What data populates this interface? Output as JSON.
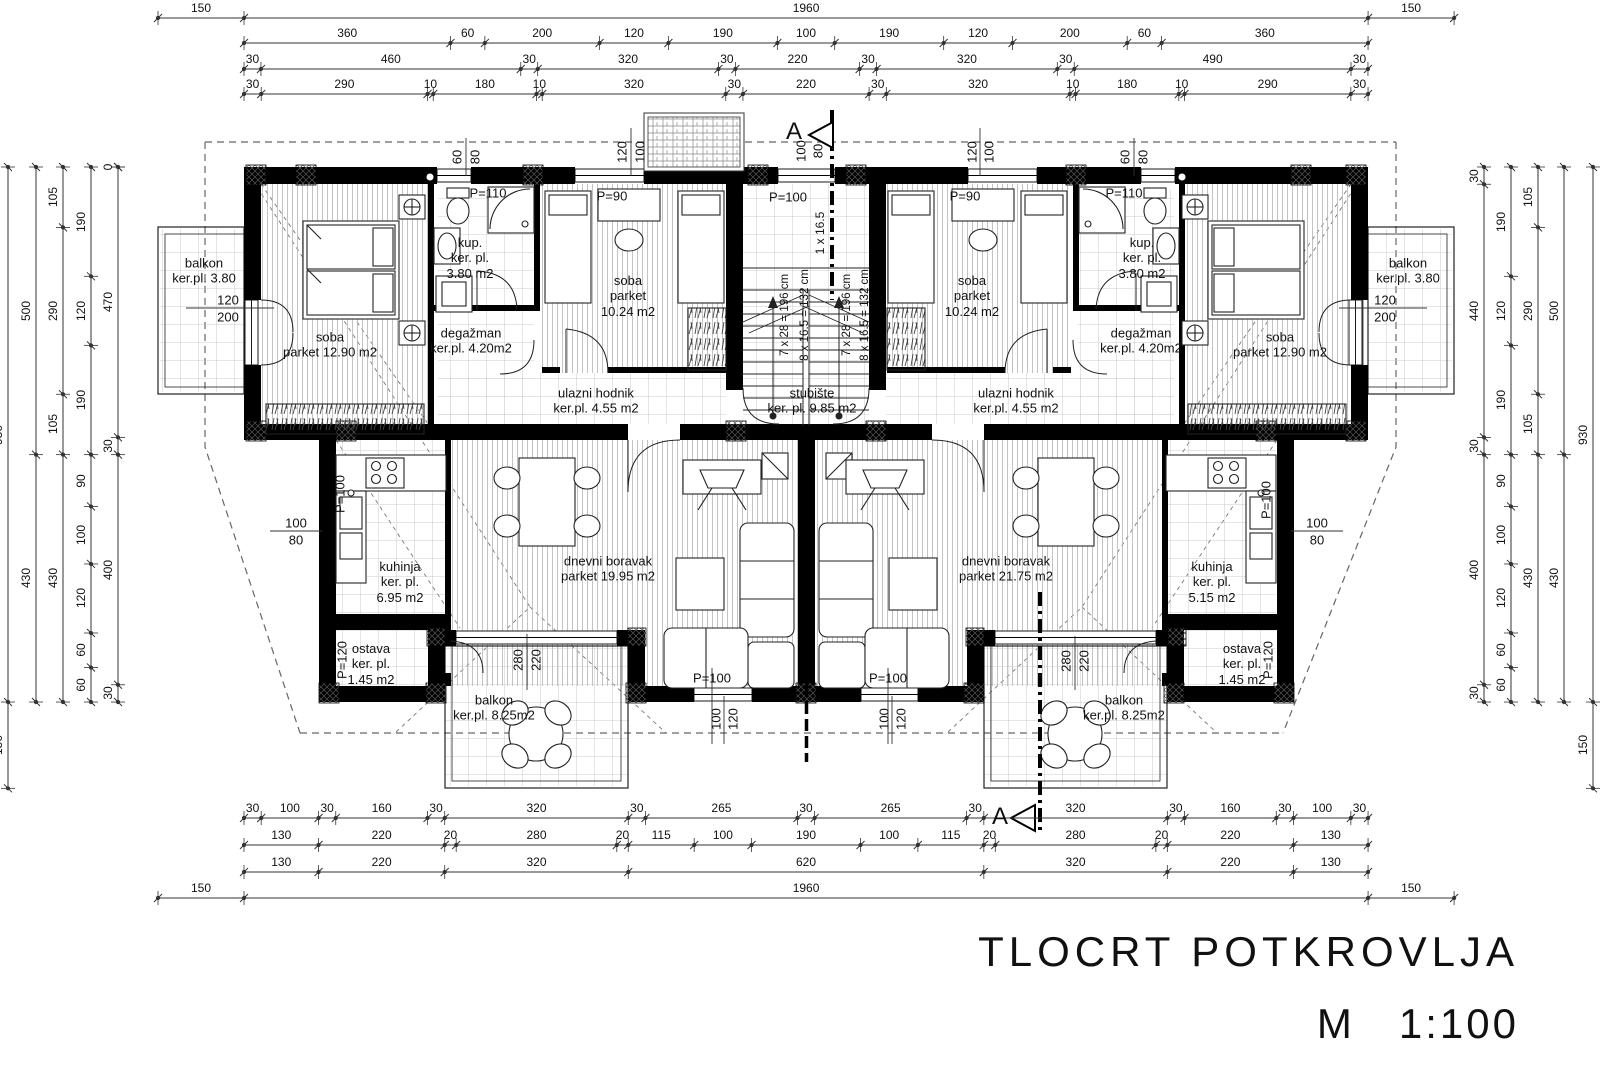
{
  "drawing": {
    "title": "TLOCRT  POTKROVLJA",
    "scale_label": "M   1:100"
  },
  "dim_chains": [
    {
      "axis": "h",
      "line": 18,
      "start": 158,
      "k": 0.5735,
      "segs": [
        "150",
        "1960",
        "150"
      ]
    },
    {
      "axis": "h",
      "line": 43,
      "start": 244,
      "k": 0.5735,
      "segs": [
        "360",
        "60",
        "200",
        "120",
        "190",
        "100",
        "190",
        "120",
        "200",
        "60",
        "360"
      ]
    },
    {
      "axis": "h",
      "line": 69,
      "start": 244,
      "k": 0.5648,
      "segs": [
        "30",
        "460",
        "30",
        "320",
        "30",
        "220",
        "30",
        "320",
        "30",
        "490",
        "30"
      ]
    },
    {
      "axis": "h",
      "line": 94,
      "start": 244,
      "k": 0.5735,
      "segs": [
        "30",
        "290",
        "10",
        "180",
        "10",
        "320",
        "30",
        "220",
        "30",
        "320",
        "10",
        "180",
        "10",
        "290",
        "30"
      ]
    },
    {
      "axis": "h",
      "line": 818,
      "start": 244,
      "k": 0.5735,
      "segs": [
        "30",
        "100",
        "30",
        "160",
        "30",
        "320",
        "30",
        "265",
        "30",
        "265",
        "30",
        "320",
        "30",
        "160",
        "30",
        "100",
        "30"
      ]
    },
    {
      "axis": "h",
      "line": 845,
      "start": 244,
      "k": 0.5735,
      "segs": [
        "130",
        "220",
        "20",
        "280",
        "20",
        "115",
        "100",
        "190",
        "100",
        "115",
        "20",
        "280",
        "20",
        "220",
        "130"
      ]
    },
    {
      "axis": "h",
      "line": 872,
      "start": 244,
      "k": 0.5735,
      "segs": [
        "130",
        "220",
        "320",
        "620",
        "320",
        "220",
        "130"
      ]
    },
    {
      "axis": "h",
      "line": 898,
      "start": 158,
      "k": 0.5735,
      "segs": [
        "150",
        "1960",
        "150"
      ]
    },
    {
      "axis": "v",
      "line": 8,
      "start": 167,
      "k": 0.5753,
      "segs": [
        "930",
        "150"
      ]
    },
    {
      "axis": "v",
      "line": 36,
      "start": 167,
      "k": 0.5753,
      "segs": [
        "500",
        "430"
      ]
    },
    {
      "axis": "v",
      "line": 63,
      "start": 167,
      "k": 0.5753,
      "segs": [
        "105",
        "290",
        "105",
        "430"
      ]
    },
    {
      "axis": "v",
      "line": 91,
      "start": 167,
      "k": 0.5753,
      "segs": [
        "190",
        "120",
        "190",
        "90",
        "100",
        "120",
        "60",
        "60"
      ]
    },
    {
      "axis": "v",
      "line": 118,
      "start": 167,
      "k": 0.5753,
      "segs": [
        "0",
        "470",
        "30",
        "400",
        "30"
      ]
    },
    {
      "axis": "v",
      "line": 1484,
      "start": 167,
      "k": 0.5753,
      "segs": [
        "30",
        "440",
        "30",
        "400",
        "30"
      ]
    },
    {
      "axis": "v",
      "line": 1511,
      "start": 167,
      "k": 0.5753,
      "segs": [
        "190",
        "120",
        "190",
        "90",
        "100",
        "120",
        "60",
        "60"
      ]
    },
    {
      "axis": "v",
      "line": 1538,
      "start": 167,
      "k": 0.5753,
      "segs": [
        "105",
        "290",
        "105",
        "430"
      ]
    },
    {
      "axis": "v",
      "line": 1564,
      "start": 167,
      "k": 0.5753,
      "segs": [
        "500",
        "430"
      ]
    },
    {
      "axis": "v",
      "line": 1593,
      "start": 167,
      "k": 0.5753,
      "segs": [
        "930",
        "150"
      ]
    }
  ],
  "labels": [
    {
      "n": "window-dim",
      "t": "60",
      "x": 457,
      "y": 157,
      "r": 1
    },
    {
      "n": "window-dim",
      "t": "80",
      "x": 475,
      "y": 157,
      "r": 1
    },
    {
      "n": "window-dim",
      "t": "120",
      "x": 622,
      "y": 152,
      "r": 1
    },
    {
      "n": "window-dim",
      "t": "100",
      "x": 640,
      "y": 152,
      "r": 1
    },
    {
      "n": "window-dim",
      "t": "100",
      "x": 801,
      "y": 151,
      "r": 1
    },
    {
      "n": "window-dim",
      "t": "80",
      "x": 818,
      "y": 151,
      "r": 1
    },
    {
      "n": "window-dim",
      "t": "120",
      "x": 972,
      "y": 152,
      "r": 1
    },
    {
      "n": "window-dim",
      "t": "100",
      "x": 989,
      "y": 152,
      "r": 1
    },
    {
      "n": "window-dim",
      "t": "60",
      "x": 1125,
      "y": 157,
      "r": 1
    },
    {
      "n": "window-dim",
      "t": "80",
      "x": 1143,
      "y": 157,
      "r": 1
    },
    {
      "n": "door-height",
      "t": "P=110",
      "x": 488,
      "y": 193
    },
    {
      "n": "door-height",
      "t": "P=90",
      "x": 612,
      "y": 196
    },
    {
      "n": "door-height",
      "t": "P=100",
      "x": 788,
      "y": 197
    },
    {
      "n": "door-height",
      "t": "P=90",
      "x": 965,
      "y": 196
    },
    {
      "n": "door-height",
      "t": "P=110",
      "x": 1124,
      "y": 193
    },
    {
      "n": "stair-note",
      "t": "1 x 16.5",
      "x": 820,
      "y": 233,
      "r": 1,
      "s": 12
    },
    {
      "n": "stair-note",
      "t": "7 x 28 = 196 cm",
      "x": 786,
      "y": 315,
      "r": 1,
      "s": 11.5
    },
    {
      "n": "stair-note",
      "t": "8 x 16.5 = 132 cm",
      "x": 806,
      "y": 315,
      "r": 1,
      "s": 11.5
    },
    {
      "n": "stair-note",
      "t": "7 x 28 = 196 cm",
      "x": 848,
      "y": 315,
      "r": 1,
      "s": 11.5
    },
    {
      "n": "stair-note",
      "t": "8 x 16.5 = 132 cm",
      "x": 866,
      "y": 315,
      "r": 1,
      "s": 11.5
    },
    {
      "n": "room-label",
      "lines": [
        "balkon",
        "ker.pl. 3.80"
      ],
      "x": 204,
      "y": 271
    },
    {
      "n": "window-dim",
      "t": "120",
      "x": 228,
      "y": 300
    },
    {
      "n": "window-dim",
      "t": "200",
      "x": 228,
      "y": 317
    },
    {
      "n": "room-label",
      "lines": [
        "soba",
        "parket 12.90 m2"
      ],
      "x": 330,
      "y": 345
    },
    {
      "n": "room-label",
      "lines": [
        "kup.",
        "ker. pl.",
        "3.80 m2"
      ],
      "x": 470,
      "y": 258
    },
    {
      "n": "room-label",
      "lines": [
        "degažman",
        "ker.pl. 4.20m2"
      ],
      "x": 471,
      "y": 341
    },
    {
      "n": "room-label",
      "lines": [
        "soba",
        "parket",
        "10.24 m2"
      ],
      "x": 628,
      "y": 296
    },
    {
      "n": "room-label",
      "lines": [
        "ulazni hodnik",
        "ker.pl. 4.55 m2"
      ],
      "x": 596,
      "y": 401
    },
    {
      "n": "room-label",
      "lines": [
        "stubište",
        "ker. pl. 9.85 m2"
      ],
      "x": 812,
      "y": 401
    },
    {
      "n": "room-label",
      "lines": [
        "soba",
        "parket",
        "10.24 m2"
      ],
      "x": 972,
      "y": 296
    },
    {
      "n": "room-label",
      "lines": [
        "ulazni hodnik",
        "ker.pl. 4.55 m2"
      ],
      "x": 1016,
      "y": 401
    },
    {
      "n": "room-label",
      "lines": [
        "kup.",
        "ker. pl.",
        "3.80 m2"
      ],
      "x": 1142,
      "y": 258
    },
    {
      "n": "room-label",
      "lines": [
        "degažman",
        "ker.pl. 4.20m2"
      ],
      "x": 1141,
      "y": 341
    },
    {
      "n": "room-label",
      "lines": [
        "soba",
        "parket 12.90 m2"
      ],
      "x": 1280,
      "y": 345
    },
    {
      "n": "room-label",
      "lines": [
        "balkon",
        "ker.pl. 3.80"
      ],
      "x": 1408,
      "y": 271
    },
    {
      "n": "window-dim",
      "t": "120",
      "x": 1385,
      "y": 300
    },
    {
      "n": "window-dim",
      "t": "200",
      "x": 1385,
      "y": 317
    },
    {
      "n": "door-height",
      "t": "P=100",
      "x": 340,
      "y": 494,
      "r": 1
    },
    {
      "n": "window-dim",
      "t": "100",
      "x": 296,
      "y": 523
    },
    {
      "n": "window-dim",
      "t": "80",
      "x": 296,
      "y": 540
    },
    {
      "n": "room-label",
      "lines": [
        "kuhinja",
        "ker. pl.",
        "6.95 m2"
      ],
      "x": 400,
      "y": 582
    },
    {
      "n": "room-label",
      "lines": [
        "ostava",
        "ker. pl.",
        "1.45 m2"
      ],
      "x": 371,
      "y": 664
    },
    {
      "n": "door-height",
      "t": "P=120",
      "x": 342,
      "y": 660,
      "r": 1
    },
    {
      "n": "room-label",
      "lines": [
        "dnevni boravak",
        "parket 19.95 m2"
      ],
      "x": 608,
      "y": 569
    },
    {
      "n": "window-dim",
      "t": "280",
      "x": 518,
      "y": 660,
      "r": 1
    },
    {
      "n": "window-dim",
      "t": "220",
      "x": 536,
      "y": 660,
      "r": 1
    },
    {
      "n": "room-label",
      "lines": [
        "balkon",
        "ker.pl. 8.25m2"
      ],
      "x": 494,
      "y": 708
    },
    {
      "n": "door-height",
      "t": "P=100",
      "x": 712,
      "y": 678
    },
    {
      "n": "window-dim",
      "t": "100",
      "x": 716,
      "y": 719,
      "r": 1
    },
    {
      "n": "window-dim",
      "t": "120",
      "x": 733,
      "y": 719,
      "r": 1
    },
    {
      "n": "door-height",
      "t": "P=100",
      "x": 888,
      "y": 678
    },
    {
      "n": "window-dim",
      "t": "100",
      "x": 884,
      "y": 719,
      "r": 1
    },
    {
      "n": "window-dim",
      "t": "120",
      "x": 901,
      "y": 719,
      "r": 1
    },
    {
      "n": "room-label",
      "lines": [
        "dnevni boravak",
        "parket 21.75 m2"
      ],
      "x": 1006,
      "y": 569
    },
    {
      "n": "room-label",
      "lines": [
        "kuhinja",
        "ker. pl.",
        "5.15 m2"
      ],
      "x": 1212,
      "y": 582
    },
    {
      "n": "room-label",
      "lines": [
        "ostava",
        "ker. pl.",
        "1.45 m2"
      ],
      "x": 1242,
      "y": 664
    },
    {
      "n": "door-height",
      "t": "P=120",
      "x": 1268,
      "y": 660,
      "r": 1
    },
    {
      "n": "door-height",
      "t": "P=100",
      "x": 1266,
      "y": 500,
      "r": 1
    },
    {
      "n": "window-dim",
      "t": "100",
      "x": 1317,
      "y": 523
    },
    {
      "n": "window-dim",
      "t": "80",
      "x": 1317,
      "y": 540
    },
    {
      "n": "window-dim",
      "t": "280",
      "x": 1066,
      "y": 661,
      "r": 1
    },
    {
      "n": "window-dim",
      "t": "220",
      "x": 1084,
      "y": 661,
      "r": 1
    },
    {
      "n": "room-label",
      "lines": [
        "balkon",
        "ker.pl. 8.25m2"
      ],
      "x": 1124,
      "y": 708
    },
    {
      "n": "section-letter",
      "t": "A",
      "x": 794,
      "y": 132,
      "s": 24
    },
    {
      "n": "section-letter",
      "t": "A",
      "x": 1000,
      "y": 817,
      "s": 24
    }
  ]
}
